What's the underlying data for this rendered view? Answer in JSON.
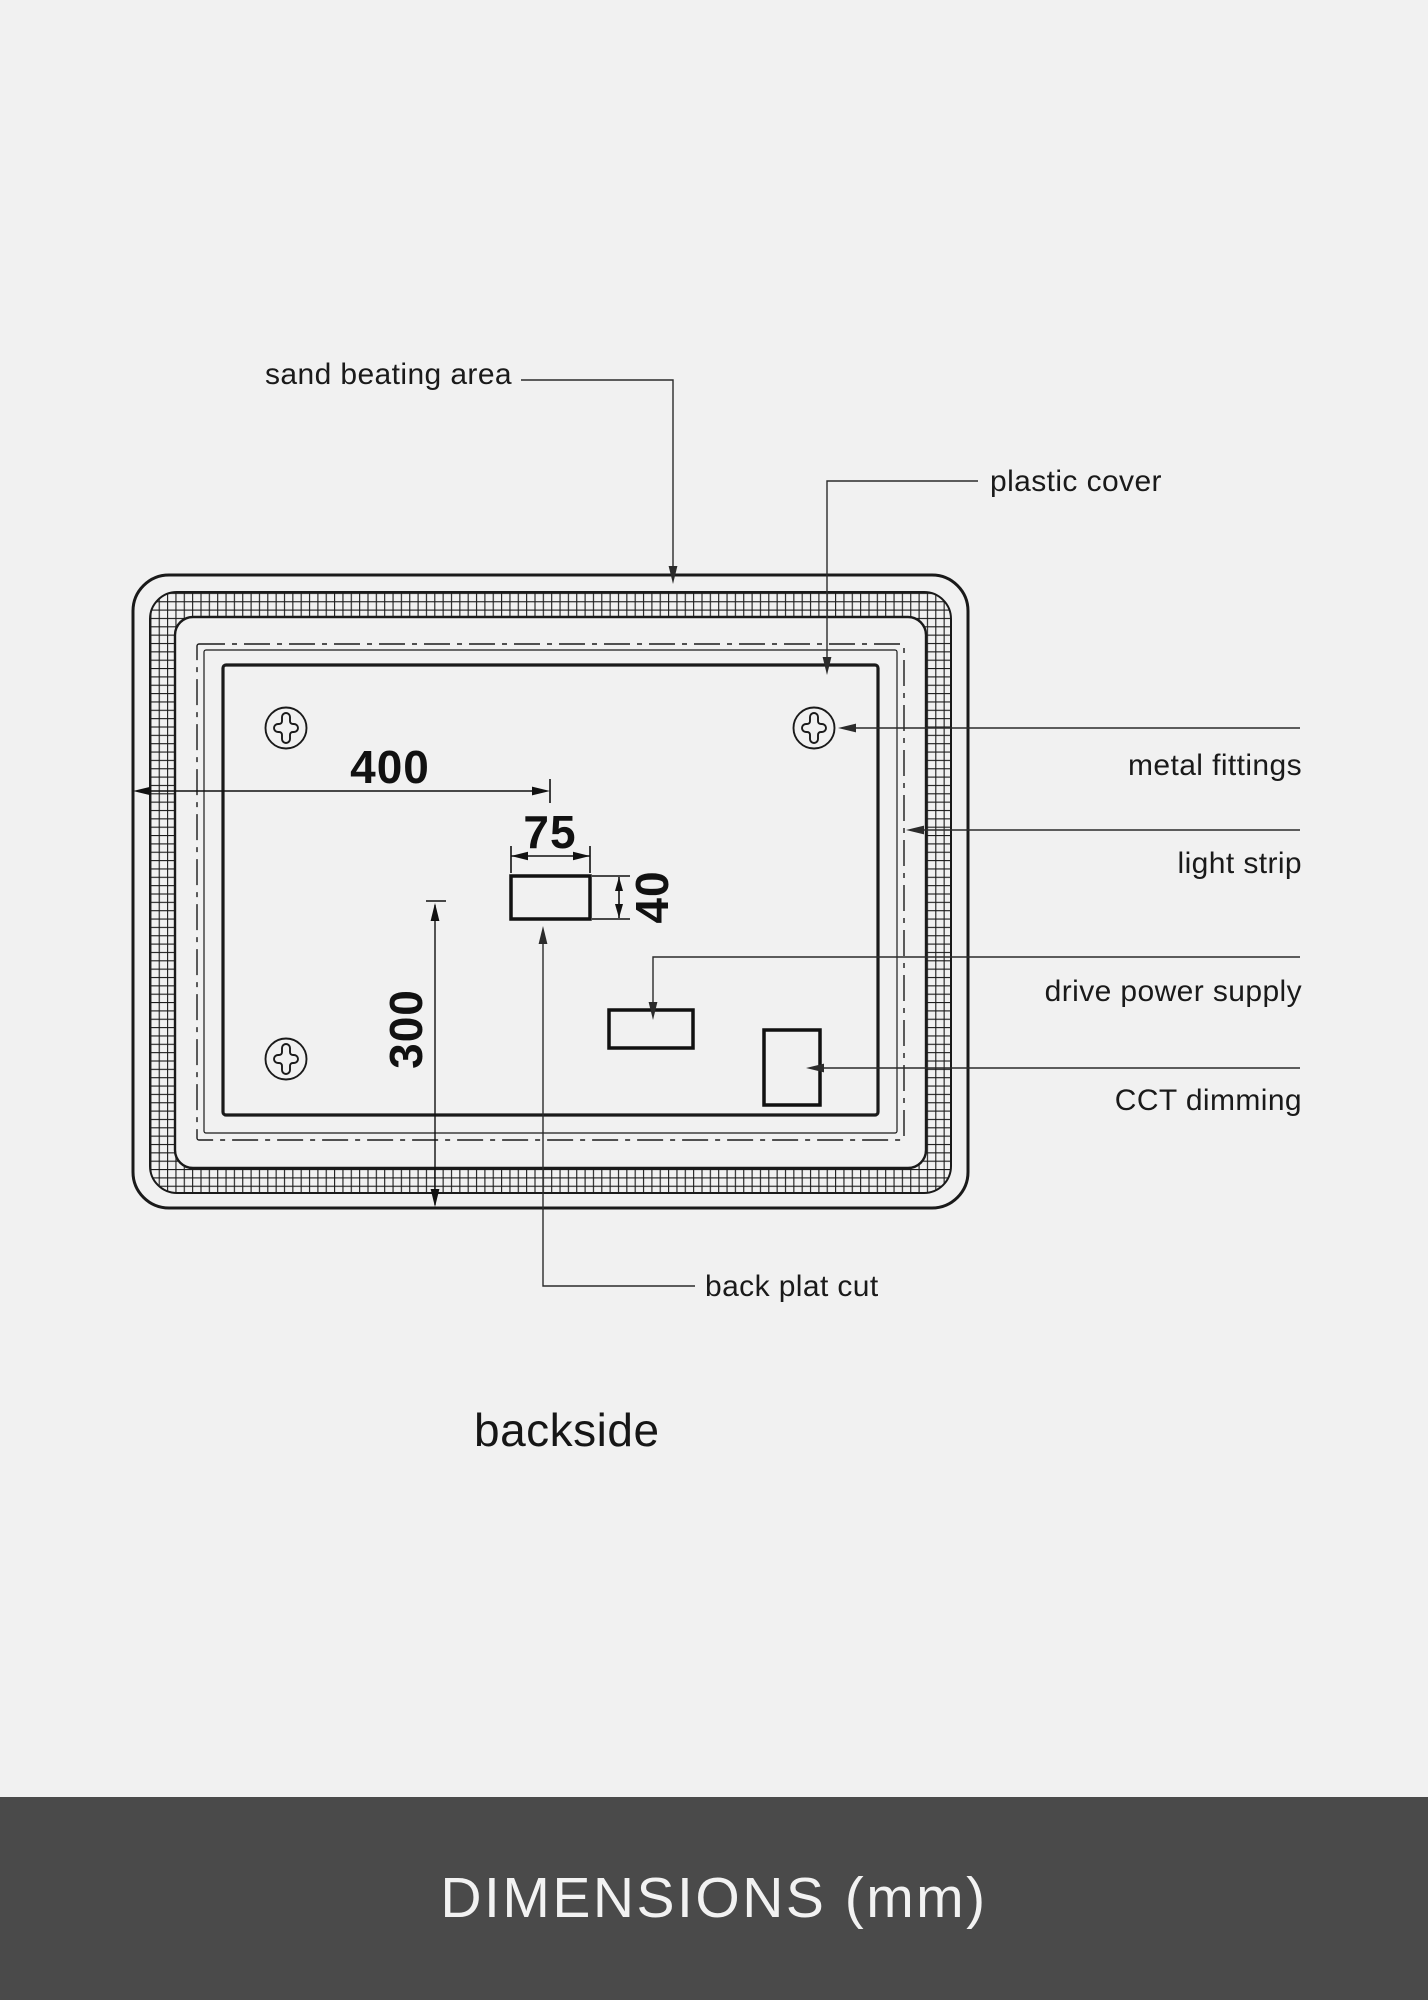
{
  "labels": {
    "sand_beating_area": "sand beating area",
    "plastic_cover": "plastic cover",
    "metal_fittings": "metal fittings",
    "light_strip": "light strip",
    "drive_power_supply": "drive power supply",
    "cct_dimming": "CCT dimming",
    "back_plat_cut": "back plat cut"
  },
  "dimensions": {
    "overall_width": "400",
    "cutout_width": "75",
    "cutout_height": "40",
    "overall_height": "300"
  },
  "view_label": "backside",
  "footer": {
    "title": "DIMENSIONS (mm)"
  },
  "icons": {
    "screw": "phillips-screw-icon"
  },
  "colors": {
    "background": "#f1f1f1",
    "line": "#1a1a1a",
    "footer_bg": "#4a4a4a",
    "footer_text": "#f2f2f2"
  }
}
